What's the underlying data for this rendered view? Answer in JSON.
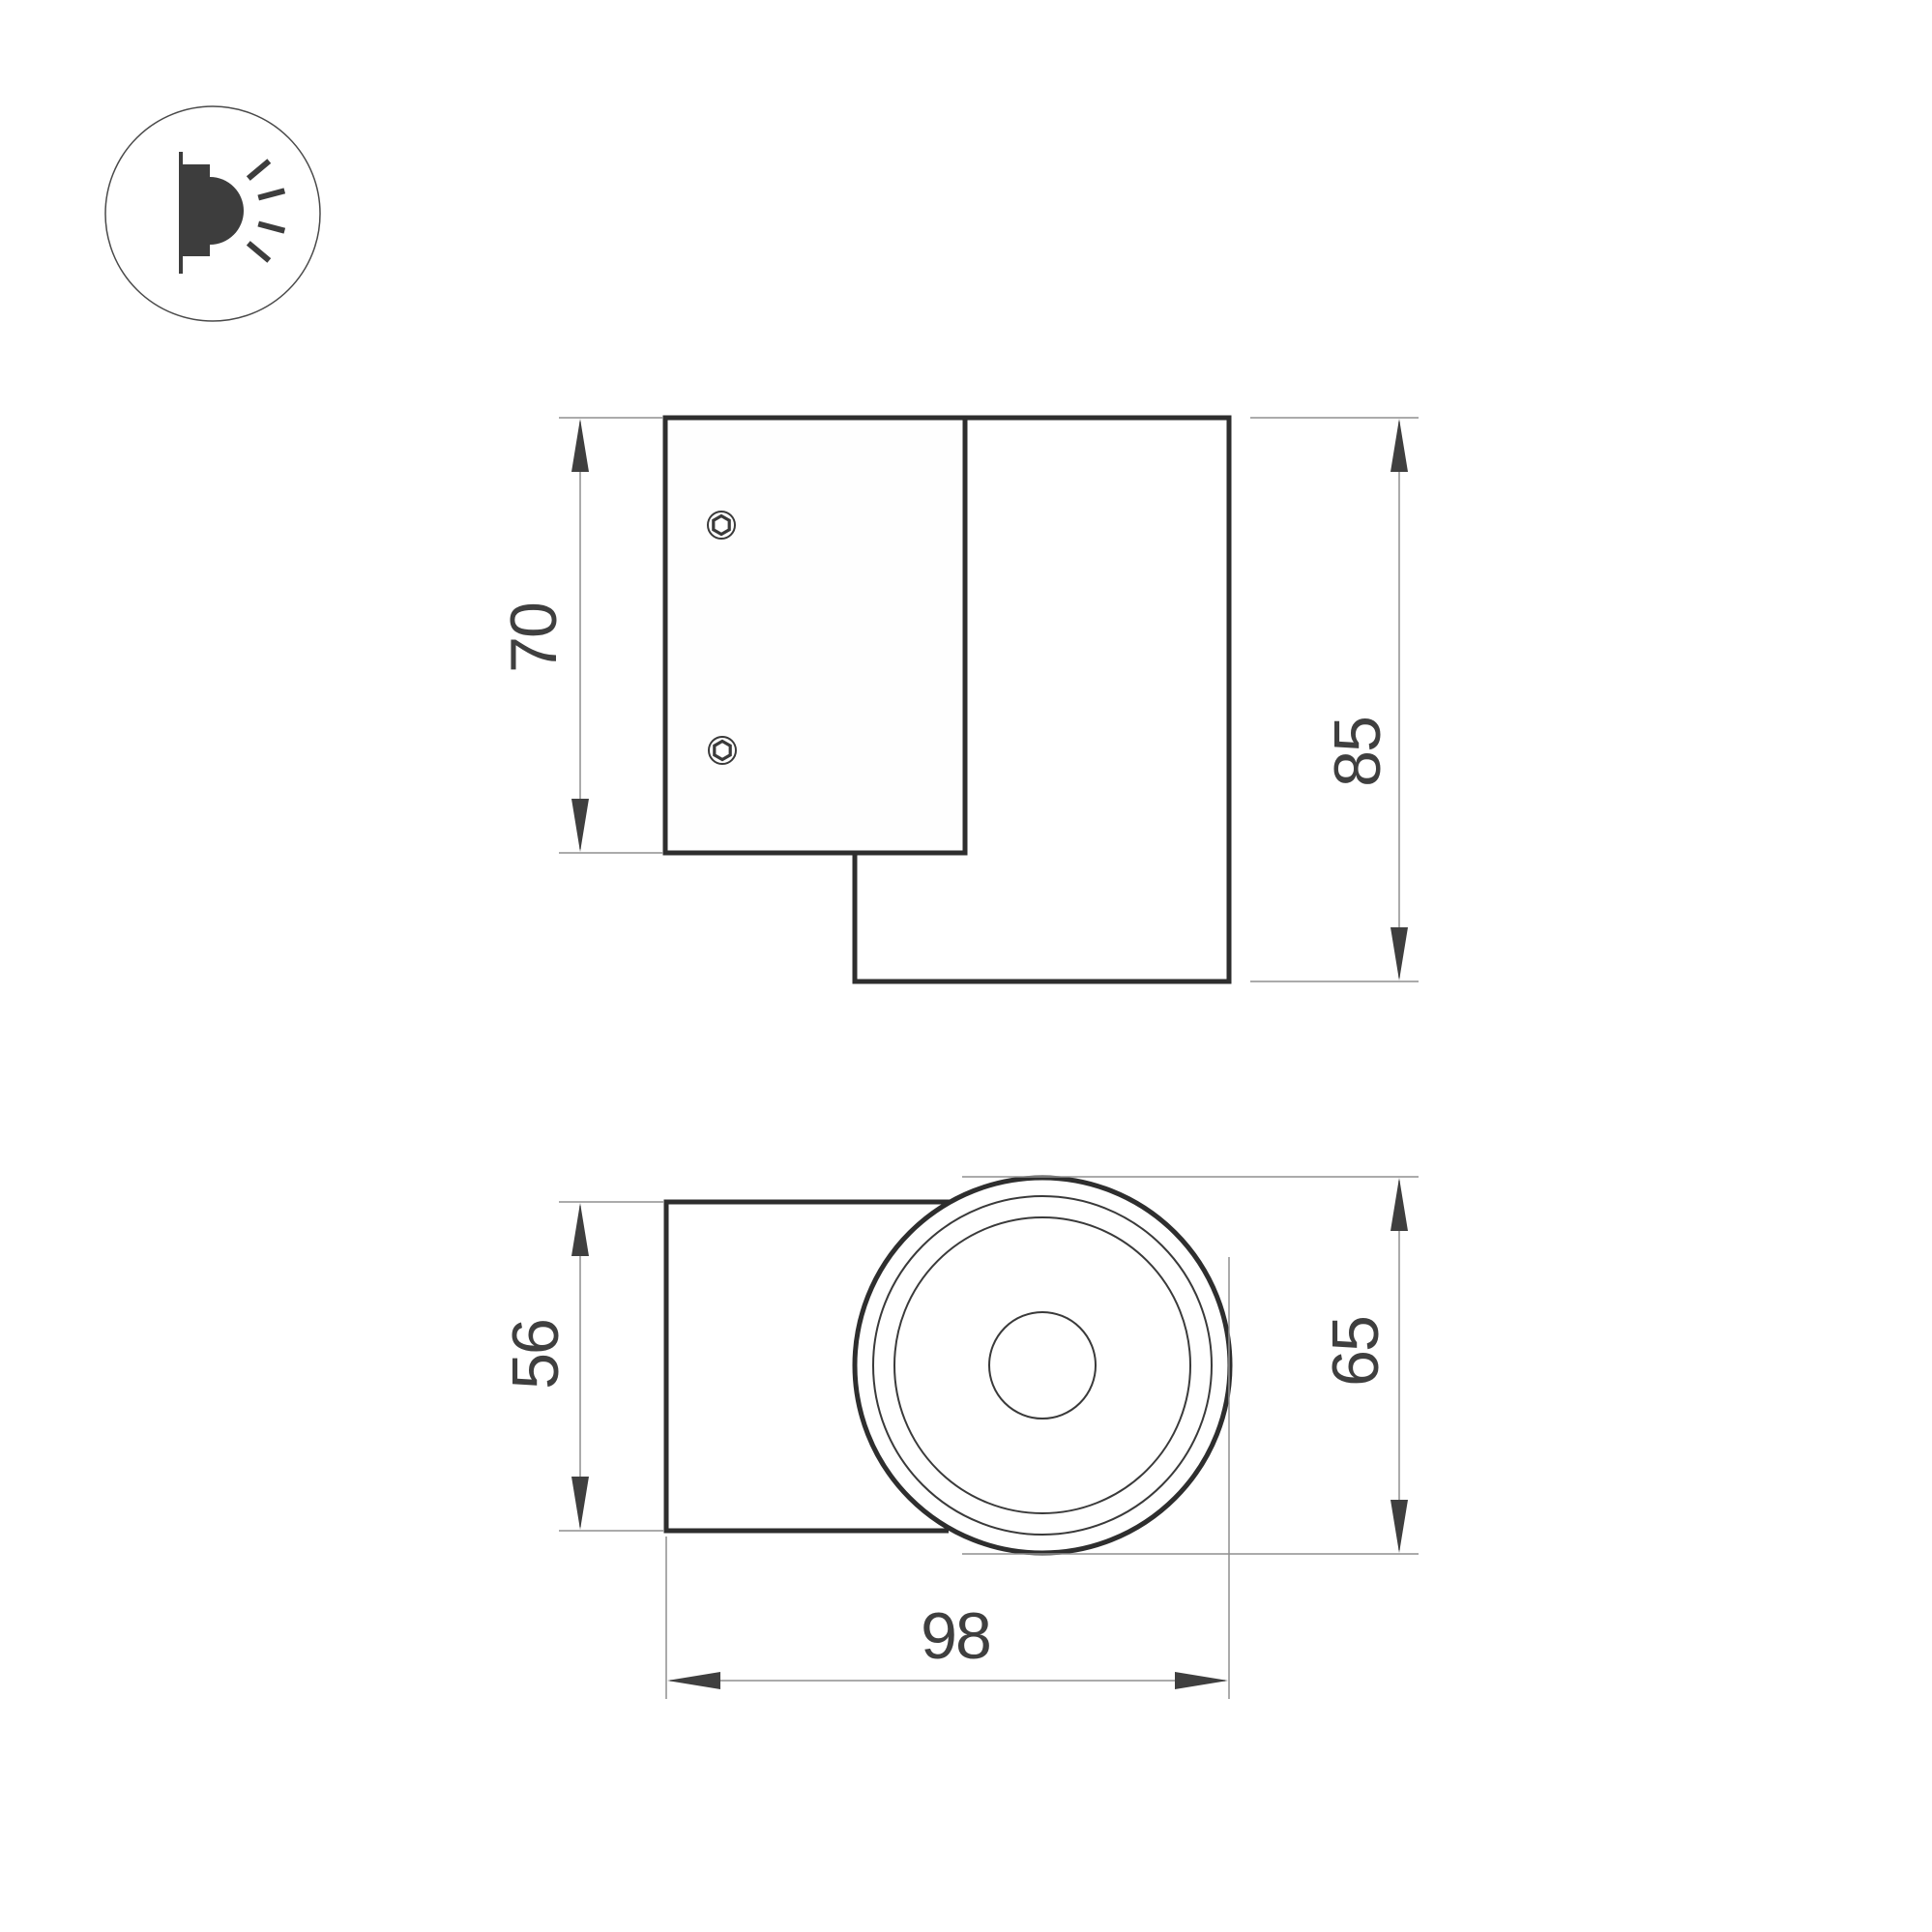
{
  "title": "Wall luminaire dimension drawing",
  "colors": {
    "background": "#ffffff",
    "outline": "#2e2e2e",
    "thin_line": "#8f8f8f",
    "arrow_and_text": "#3f3f3f",
    "icon_glyph": "#3d3d3d",
    "icon_ring": "#4a4a4a"
  },
  "icon": {
    "name": "wall-mounted-light-icon",
    "meaning": "wall-mounted luminaire emitting light sideways"
  },
  "side_view": {
    "plate_height": "70",
    "overall_height": "85",
    "screw_count": "2"
  },
  "front_view": {
    "body_width": "56",
    "diameter": "65",
    "overall_depth": "98"
  }
}
